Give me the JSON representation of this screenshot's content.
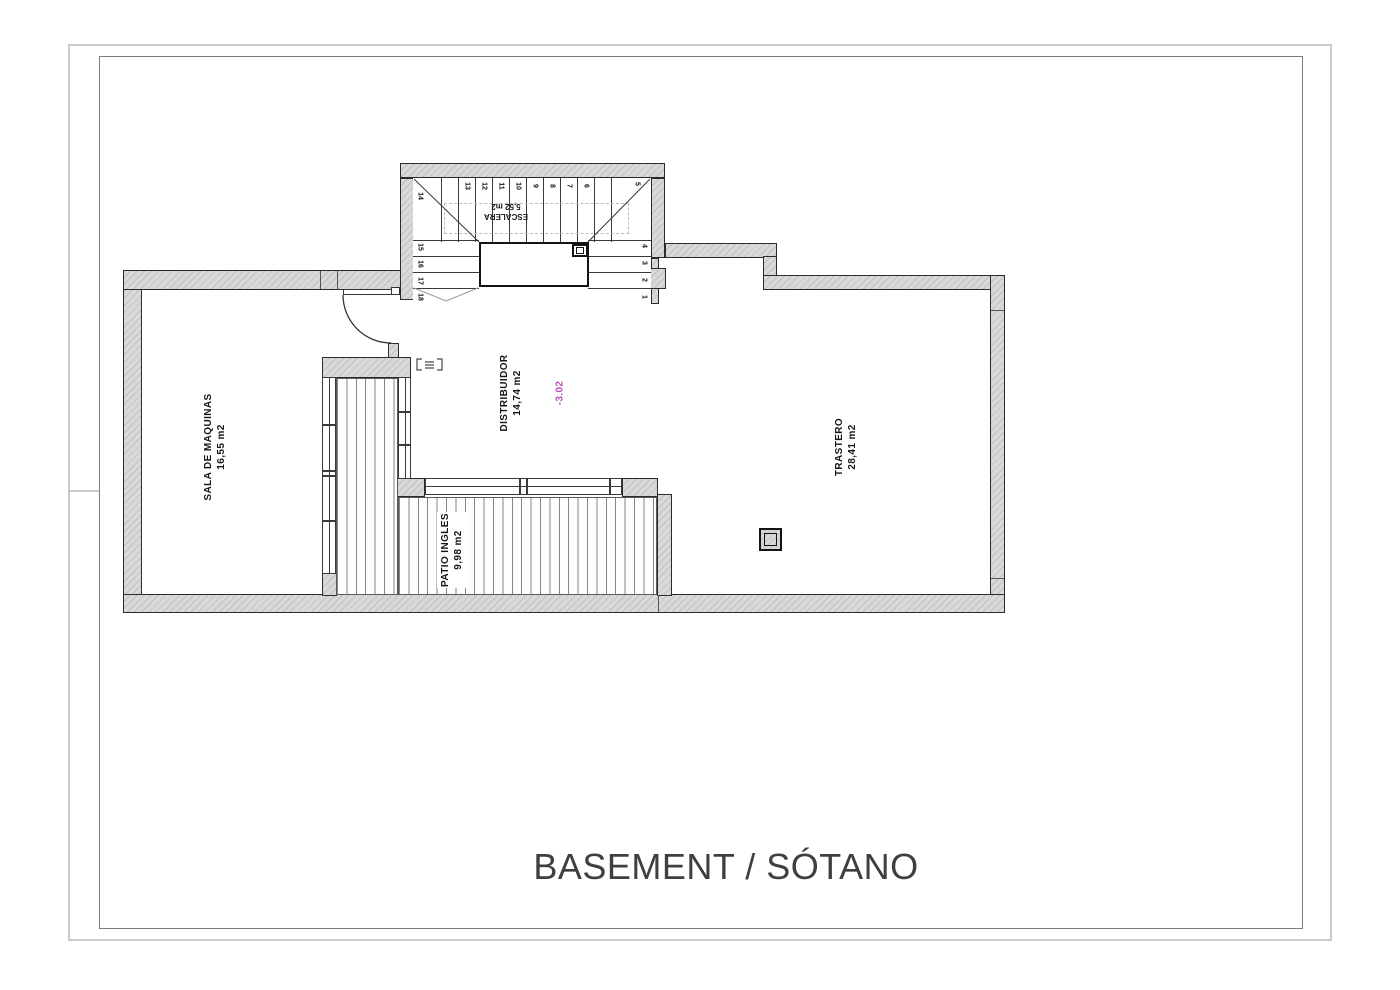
{
  "sheet": {
    "title": "BASEMENT / SÓTANO"
  },
  "rooms": {
    "sala": {
      "name": "SALA DE MAQUINAS",
      "area": "16,55 m2"
    },
    "distribuidor": {
      "name": "DISTRIBUIDOR",
      "area": "14,74 m2"
    },
    "trastero": {
      "name": "TRASTERO",
      "area": "28,41 m2"
    },
    "patio": {
      "name": "PATIO INGLES",
      "area": "9,98 m2"
    },
    "escalera": {
      "name": "ESCALERA",
      "area": "5,52 m2"
    }
  },
  "level_mark": "-3.02",
  "stairs": {
    "treads": [
      "1",
      "2",
      "3",
      "4",
      "5",
      "6",
      "7",
      "8",
      "9",
      "10",
      "11",
      "12",
      "13",
      "14",
      "15",
      "16",
      "17",
      "18"
    ]
  },
  "colors": {
    "level_mark": "#b94fc0",
    "wall_fill": "#d9d9d9",
    "wall_hatch": "#c1c1c1",
    "line": "#2b2b2b",
    "title_text": "#3f3f3f"
  }
}
